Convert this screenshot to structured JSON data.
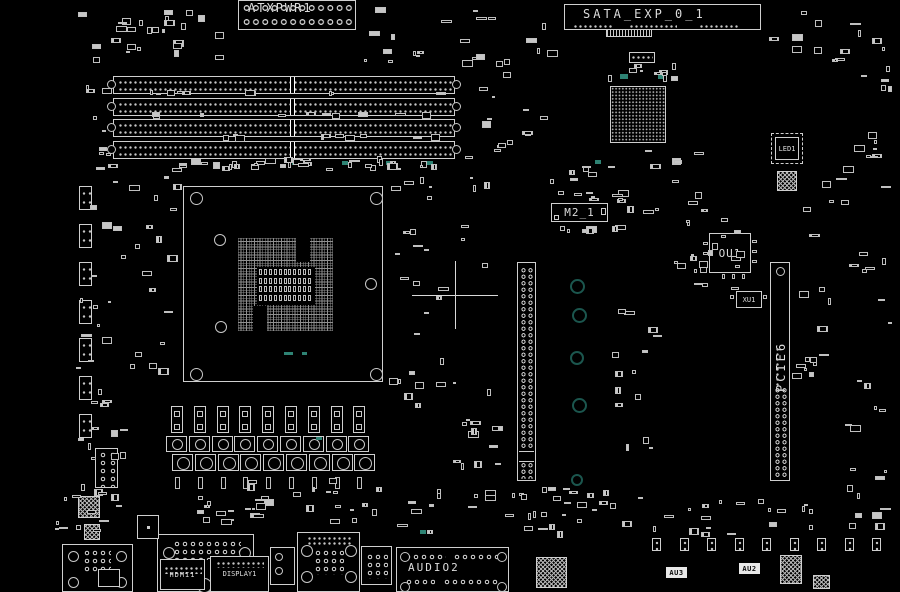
{
  "board": {
    "type": "motherboard-boardview",
    "colors": {
      "background": "#000000",
      "silkscreen": "#d0d0d0",
      "accent_teal_ring": "#1b564e",
      "accent_teal_fill": "#2e8374"
    }
  },
  "components": {
    "atx_power": {
      "label": "ATXPWR1"
    },
    "sata_exp": {
      "label": "SATA_EXP_0_1"
    },
    "m2": {
      "label": "M2_1"
    },
    "ou1": {
      "label": "OU1"
    },
    "xu1": {
      "label": "XU1"
    },
    "led1": {
      "label": "LED1"
    },
    "pcie6": {
      "label": "PCIE6"
    },
    "hdmi": {
      "label": "HDMI1"
    },
    "display": {
      "label": "DISPLAY1"
    },
    "audio": {
      "label": "AUDIO2"
    },
    "au2": {
      "label": "AU2"
    },
    "au3": {
      "label": "AU3"
    }
  }
}
